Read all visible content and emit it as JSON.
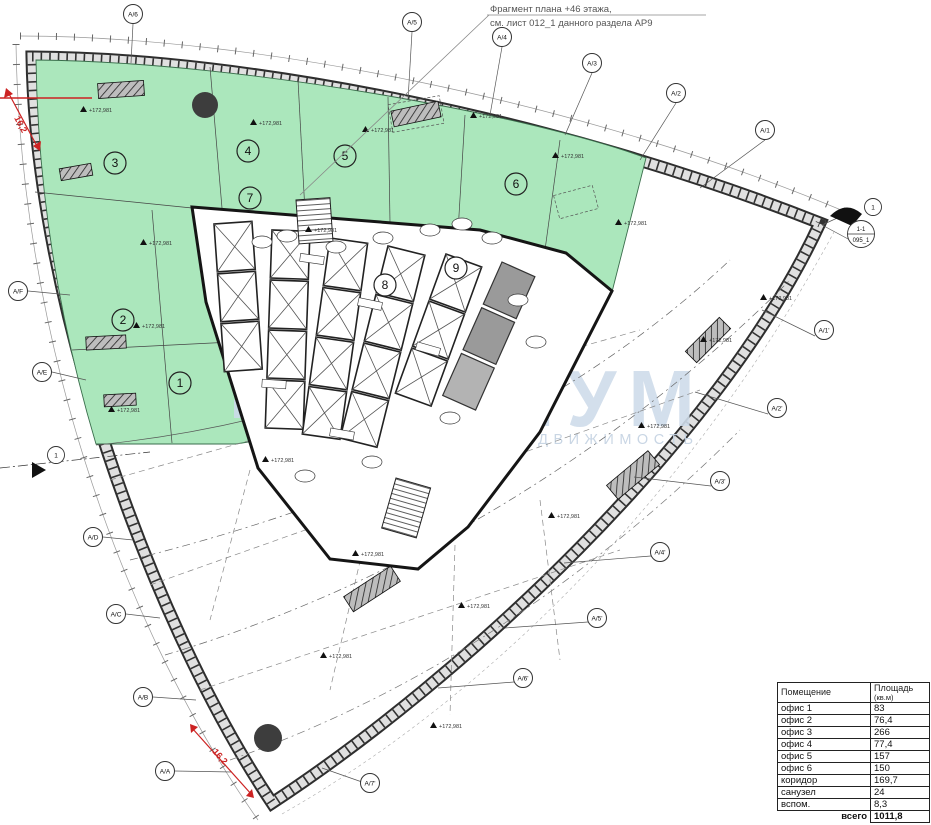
{
  "colors": {
    "green": "#abe7bc",
    "facade": "#e0e0e0",
    "ink": "#1a1a1a",
    "watermark": "#ccdaea",
    "red": "#cc2222"
  },
  "annotation": {
    "line1": "Фрагмент плана +46 этажа,",
    "line2": "см. лист 012_1 данного раздела АР9"
  },
  "watermark": {
    "logo": "pixel-grid-logo",
    "title": "ДИУМ",
    "subtitle": "КОММЕРЧЕСКАЯ НЕДВИЖИМОСТЬ"
  },
  "plan": {
    "room_numbers": [
      "1",
      "2",
      "3",
      "4",
      "5",
      "6",
      "7",
      "8",
      "9"
    ],
    "elevation_label": "+172,981",
    "axes_top": [
      "А/6",
      "А/5",
      "А/4",
      "А/3",
      "А/2",
      "А/1"
    ],
    "axes_left": [
      "А/F",
      "А/E",
      "А/D",
      "А/C",
      "А/B",
      "А/A"
    ],
    "axes_diag": [
      "А/7'",
      "А/6'",
      "А/5'",
      "А/4'",
      "А/3'",
      "А/2'",
      "А/1'"
    ],
    "section": {
      "bubble": "1",
      "cut": "1-1",
      "sheet": "095_1"
    },
    "red_marks": {
      "left": "16,2",
      "bottom": "16,2"
    }
  },
  "table": {
    "header_room": "Помещение",
    "header_area_1": "Площадь",
    "header_area_2": "(кв.м)",
    "rows": [
      {
        "name": "офис 1",
        "area": "83"
      },
      {
        "name": "офис 2",
        "area": "76,4"
      },
      {
        "name": "офис 3",
        "area": "266"
      },
      {
        "name": "офис 4",
        "area": "77,4"
      },
      {
        "name": "офис 5",
        "area": "157"
      },
      {
        "name": "офис 6",
        "area": "150"
      },
      {
        "name": "коридор",
        "area": "169,7"
      },
      {
        "name": "санузел",
        "area": "24"
      },
      {
        "name": "вспом.",
        "area": "8,3"
      }
    ],
    "total_label": "всего",
    "total_value": "1011,8"
  }
}
